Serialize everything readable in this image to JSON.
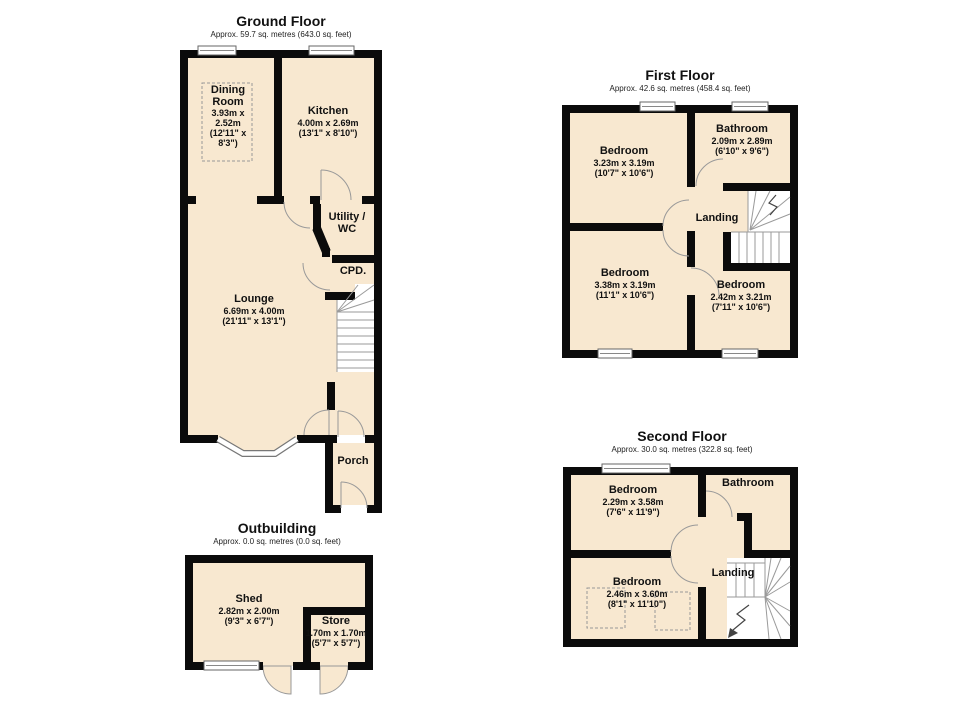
{
  "palette": {
    "wall": "#0b0b0b",
    "room_fill": "#f8e8d0",
    "line_grey": "#999999",
    "text": "#111111",
    "background": "#ffffff"
  },
  "floors": [
    {
      "id": "ground-floor",
      "title": "Ground Floor",
      "subtitle": "Approx. 59.7 sq. metres (643.0 sq. feet)",
      "rooms": [
        {
          "name": "Dining Room",
          "dims_metric": "3.93m x 2.52m",
          "dims_imperial": "(12'11\" x 8'3\")"
        },
        {
          "name": "Kitchen",
          "dims_metric": "4.00m x 2.69m",
          "dims_imperial": "(13'1\" x 8'10\")"
        },
        {
          "name": "Utility / WC"
        },
        {
          "name": "CPD."
        },
        {
          "name": "Lounge",
          "dims_metric": "6.69m x 4.00m",
          "dims_imperial": "(21'11\" x 13'1\")"
        },
        {
          "name": "Porch"
        }
      ]
    },
    {
      "id": "first-floor",
      "title": "First Floor",
      "subtitle": "Approx. 42.6 sq. metres (458.4 sq. feet)",
      "rooms": [
        {
          "name": "Bedroom",
          "dims_metric": "3.23m x 3.19m",
          "dims_imperial": "(10'7\" x 10'6\")"
        },
        {
          "name": "Bathroom",
          "dims_metric": "2.09m x 2.89m",
          "dims_imperial": "(6'10\" x 9'6\")"
        },
        {
          "name": "Landing"
        },
        {
          "name": "Bedroom",
          "dims_metric": "3.38m x 3.19m",
          "dims_imperial": "(11'1\" x 10'6\")"
        },
        {
          "name": "Bedroom",
          "dims_metric": "2.42m x 3.21m",
          "dims_imperial": "(7'11\" x 10'6\")"
        }
      ]
    },
    {
      "id": "second-floor",
      "title": "Second Floor",
      "subtitle": "Approx. 30.0 sq. metres (322.8 sq. feet)",
      "rooms": [
        {
          "name": "Bedroom",
          "dims_metric": "2.29m x 3.58m",
          "dims_imperial": "(7'6\" x 11'9\")"
        },
        {
          "name": "Bathroom"
        },
        {
          "name": "Landing"
        },
        {
          "name": "Bedroom",
          "dims_metric": "2.46m x 3.60m",
          "dims_imperial": "(8'1\" x 11'10\")"
        }
      ]
    },
    {
      "id": "outbuilding",
      "title": "Outbuilding",
      "subtitle": "Approx. 0.0 sq. metres (0.0 sq. feet)",
      "rooms": [
        {
          "name": "Shed",
          "dims_metric": "2.82m x 2.00m",
          "dims_imperial": "(9'3\" x 6'7\")"
        },
        {
          "name": "Store",
          "dims_metric": "1.70m x 1.70m",
          "dims_imperial": "(5'7\" x 5'7\")"
        }
      ]
    }
  ]
}
